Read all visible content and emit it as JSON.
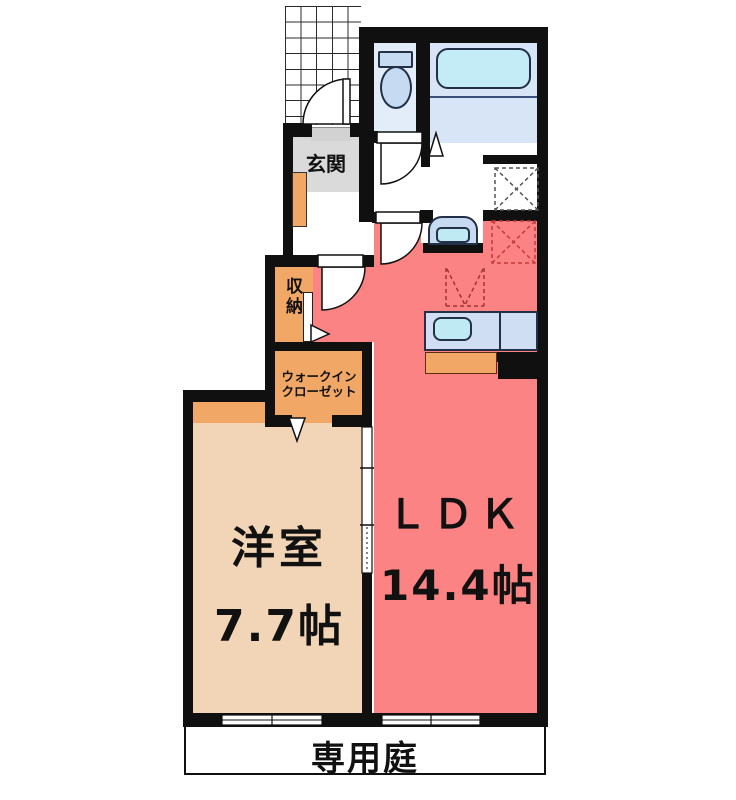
{
  "plan_title": "1LDK floor plan",
  "rooms": {
    "genkan": {
      "label": "玄関"
    },
    "shunou": {
      "label": "収納"
    },
    "walk_in_closet": {
      "label_line1": "ウォークイン",
      "label_line2": "クローゼット"
    },
    "bedroom": {
      "label": "洋室",
      "size": "7.7帖"
    },
    "ldk": {
      "label": "ＬＤＫ",
      "size": "14.4帖"
    },
    "garden": {
      "label": "専用庭"
    }
  },
  "fixtures": {
    "toilet": "toilet",
    "bathtub": "bathtub",
    "washbasin": "washbasin",
    "kitchen_sink": "kitchen-sink",
    "washing_machine_space": "washing-machine-space",
    "refrigerator_space": "refrigerator-space",
    "range_hood": "range-hood-dashed-v",
    "shoe_cabinet": "shoe-cabinet",
    "entrance_porch": "entrance-porch-grid"
  },
  "colors": {
    "wall": "#101010",
    "ldk_floor": "#fb8383",
    "bedroom_floor": "#f2d4b6",
    "closet_orange": "#f1a766",
    "genkan_gray": "#dadada",
    "toilet_floor": "#e3edf9",
    "bath_floor": "#d7e5f6",
    "fixture_blue": "#c6daf2",
    "tub_cyan": "#c3ecf7",
    "counter_blue": "#cfdef2",
    "fridge_dash": "#c43b3b"
  }
}
